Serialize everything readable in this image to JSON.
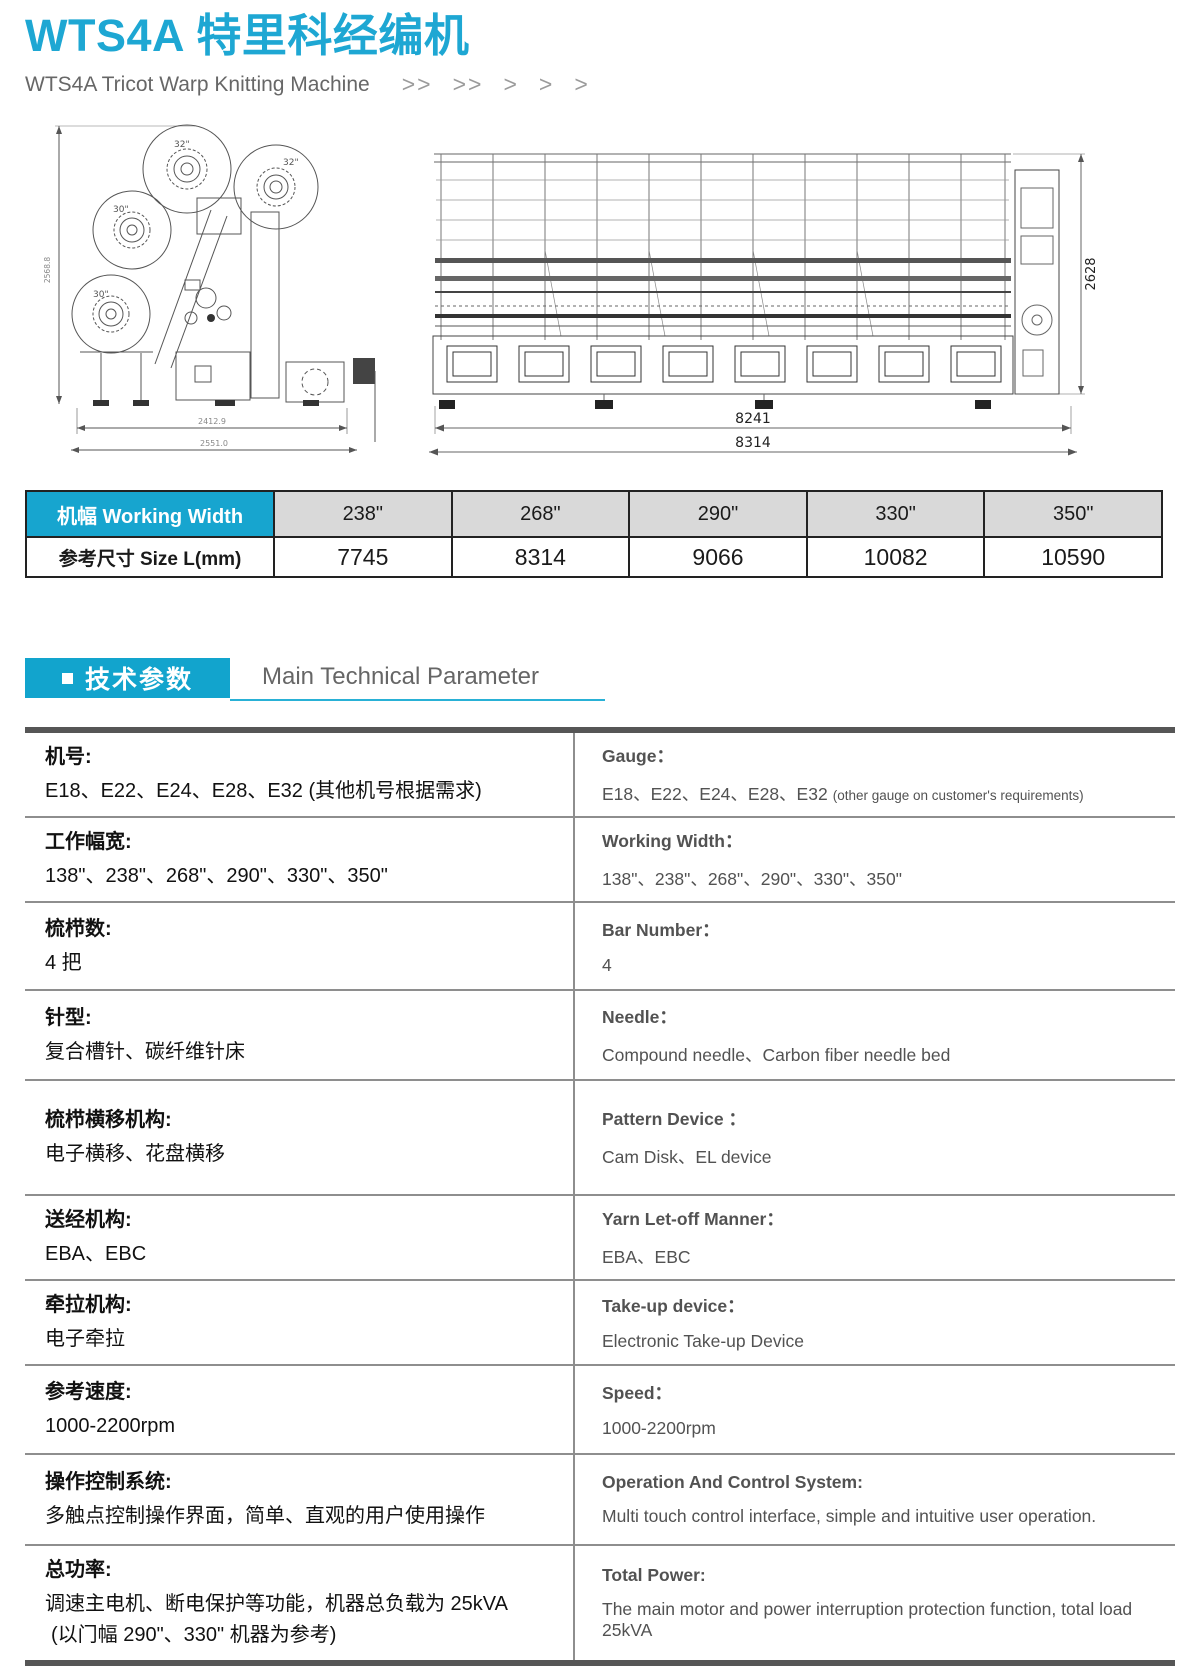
{
  "header": {
    "title": "WTS4A 特里科经编机",
    "subtitle": "WTS4A Tricot Warp Knitting Machine",
    "chevrons": [
      ">>",
      ">>",
      ">",
      ">",
      ">"
    ]
  },
  "drawings": {
    "side": {
      "beams": [
        "32\"",
        "32\"",
        "30\"",
        "30\""
      ],
      "dim_height": "2568.8",
      "dim_width_top": "2412.9",
      "dim_width_bottom": "2551.0"
    },
    "front": {
      "dim_height": "2628",
      "dim_width_inner": "8241",
      "dim_width_outer": "8314"
    }
  },
  "width_table": {
    "header_label": "机幅 Working Width",
    "row_label": "参考尺寸 Size L(mm)",
    "widths": [
      "238\"",
      "268\"",
      "290\"",
      "330\"",
      "350\""
    ],
    "sizes": [
      "7745",
      "8314",
      "9066",
      "10082",
      "10590"
    ]
  },
  "section": {
    "zh": "技术参数",
    "en": "Main Technical Parameter"
  },
  "specs": {
    "rows": [
      {
        "zh_label": "机号:",
        "zh_value": "E18、E22、E24、E28、E32 (其他机号根据需求)",
        "en_label": "Gauge：",
        "en_value": "E18、E22、E24、E28、E32",
        "en_note": "(other gauge on customer's requirements)"
      },
      {
        "zh_label": "工作幅宽:",
        "zh_value": "138\"、238\"、268\"、290\"、330\"、350\"",
        "en_label": "Working Width：",
        "en_value": "138\"、238\"、268\"、290\"、330\"、350\""
      },
      {
        "zh_label": "梳栉数:",
        "zh_value": "4 把",
        "en_label": "Bar Number：",
        "en_value": "4"
      },
      {
        "zh_label": "针型:",
        "zh_value": "复合槽针、碳纤维针床",
        "en_label": "Needle：",
        "en_value": "Compound needle、Carbon fiber needle bed"
      },
      {
        "zh_label": "梳栉横移机构:",
        "zh_value": "电子横移、花盘横移",
        "en_label": "Pattern Device ：",
        "en_value": "Cam Disk、EL device"
      },
      {
        "zh_label": "送经机构:",
        "zh_value": "EBA、EBC",
        "en_label": "Yarn Let-off Manner：",
        "en_value": "EBA、EBC"
      },
      {
        "zh_label": "牵拉机构:",
        "zh_value": "电子牵拉",
        "en_label": "Take-up device：",
        "en_value": "Electronic Take-up Device"
      },
      {
        "zh_label": "参考速度:",
        "zh_value": "1000-2200rpm",
        "en_label": "Speed：",
        "en_value": "1000-2200rpm"
      },
      {
        "zh_label": "操作控制系统:",
        "zh_value": "多触点控制操作界面，简单、直观的用户使用操作",
        "en_label": "Operation And Control System:",
        "en_value": "Multi touch control interface, simple and intuitive user operation."
      },
      {
        "zh_label": "总功率:",
        "zh_value": "调速主电机、断电保护等功能，机器总负载为 25kVA",
        "zh_value2": "(以门幅 290\"、330\" 机器为参考)",
        "en_label": "Total Power:",
        "en_value": "The main motor and power interruption protection function,  total load 25kVA"
      }
    ]
  }
}
